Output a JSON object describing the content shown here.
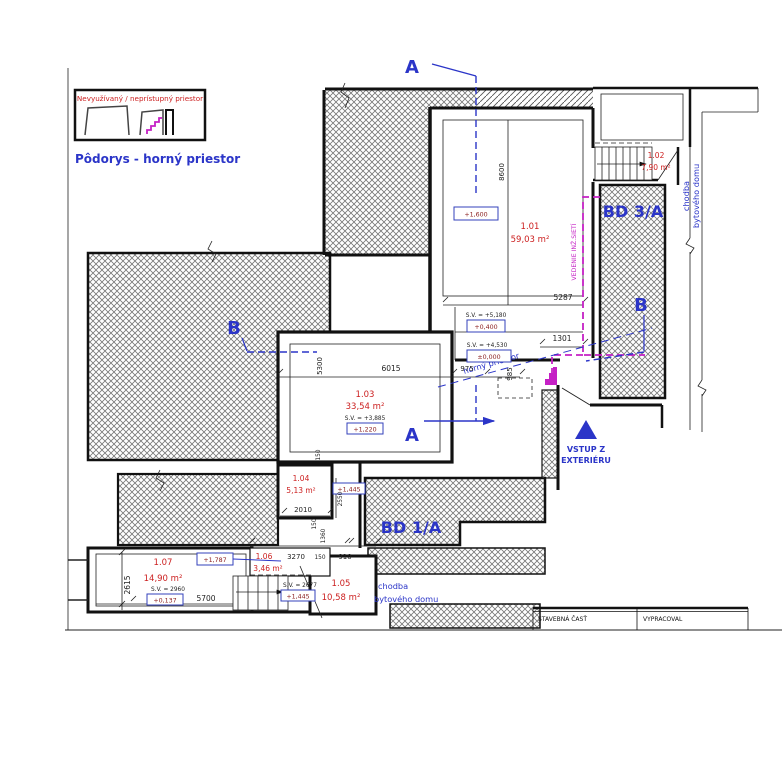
{
  "legend": {
    "title": "Nevyužívaný / neprístupný priestor",
    "caption": "Pôdorys - horný priestor"
  },
  "section_marks": {
    "a": "A",
    "b": "B"
  },
  "rooms": {
    "r101": {
      "num": "1.01",
      "area": "59,03 m²"
    },
    "r102": {
      "num": "1.02",
      "area": "7,90 m²"
    },
    "r103": {
      "num": "1.03",
      "area": "33,54 m²",
      "sv": "S.V. = +3,885",
      "level": "+1,220"
    },
    "r104": {
      "num": "1.04",
      "area": "5,13 m²"
    },
    "r105": {
      "num": "1.05",
      "area": "10,58 m²"
    },
    "r106": {
      "num": "1.06",
      "area": "3,46 m²"
    },
    "r107": {
      "num": "1.07",
      "area": "14,90 m²",
      "sv": "S.V. = 2960",
      "level": "+0,137"
    }
  },
  "elevations": {
    "e1600": "+1,600",
    "sv5180": "S.V. = +5,180",
    "e0400": "+0,400",
    "sv4530": "S.V. = +4,530",
    "e0000": "±0,000",
    "e1445_mid": "+1,445",
    "e1787": "+1,787",
    "sv2677": "S.V. = 2677",
    "e1445_stair": "+1,445"
  },
  "dims": {
    "d8600": "8600",
    "d5287": "5287",
    "d1301": "1301",
    "d985": "985",
    "d5300": "5300",
    "d6015": "6015",
    "d975": "975",
    "d150_103": "150",
    "d2010": "2010",
    "d2550": "2550",
    "d150_104": "150",
    "d1360": "1360",
    "d3270": "3270",
    "d150_106": "150",
    "d910": "910",
    "d5700": "5700",
    "d2615": "2615"
  },
  "areas": {
    "bd3a": "BD 3/A",
    "bd1a": "BD 1/A"
  },
  "annotations": {
    "chodba_line1": "chodba",
    "chodba_line2": "bytového domu",
    "vedenie": "VEDENIE INŽ.SIETÍ",
    "horny_priestor": "horný priestor",
    "vstup_line1": "VSTUP Z",
    "vstup_line2": "EXTERIÉRU"
  },
  "titleblock": {
    "c1": "STAVEBNÁ ČASŤ",
    "c2": "VYPRACOVAL"
  }
}
